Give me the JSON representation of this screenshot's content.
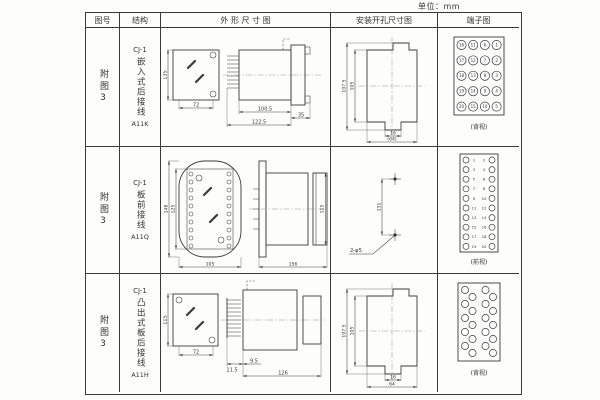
{
  "unit_label": "单位：mm",
  "headers": {
    "fig_no": "图号",
    "structure": "结构",
    "outline": "外 形 尺 寸 图",
    "install": "安装开孔尺寸图",
    "terminal": "端子图"
  },
  "rows": [
    {
      "fig_no": "附图3",
      "series": "CJ-1",
      "structure": "嵌入式后接线",
      "model": "A11K",
      "outline": {
        "front_height": "135",
        "front_width": "72",
        "body_length": "100.5",
        "overall_length": "122.5",
        "flange_depth": "35"
      },
      "install": {
        "outer_height": "107.5",
        "inner_height": "105",
        "notch_width": "16",
        "overall_width": "(64)"
      },
      "terminal": {
        "view_label": "(背视)",
        "numbers": [
          [
            16,
            11,
            6,
            1
          ],
          [
            17,
            12,
            7,
            2
          ],
          [
            18,
            13,
            8,
            3
          ],
          [
            19,
            14,
            9,
            4
          ],
          [
            20,
            15,
            10,
            5
          ]
        ]
      }
    },
    {
      "fig_no": "附图3",
      "series": "CJ-1",
      "structure": "板前接线",
      "model": "A11Q",
      "outline": {
        "front_height": "148",
        "front_inner_height": "125",
        "front_width": "105",
        "side_length": "156",
        "side_height": "115"
      },
      "install": {
        "hole_spacing": "131",
        "hole_label": "2-φ5"
      },
      "terminal": {
        "view_label": "(前视)",
        "left_numbers": [
          1,
          3,
          5,
          7,
          9,
          11,
          13,
          15,
          17,
          19
        ],
        "right_numbers": [
          2,
          4,
          6,
          8,
          10,
          12,
          14,
          16,
          18,
          20
        ]
      }
    },
    {
      "fig_no": "附图3",
      "series": "CJ-1",
      "structure": "凸出式板后接线",
      "model": "A11H",
      "outline": {
        "front_height": "115",
        "front_width": "72",
        "pin_length": "11.5",
        "pin_offset": "9.5",
        "body_length": "126"
      },
      "install": {
        "outer_height": "107.5",
        "inner_height": "105",
        "notch_width": "16",
        "overall_width": "64"
      },
      "terminal": {
        "view_label": "(背视)",
        "count": 20
      }
    }
  ]
}
